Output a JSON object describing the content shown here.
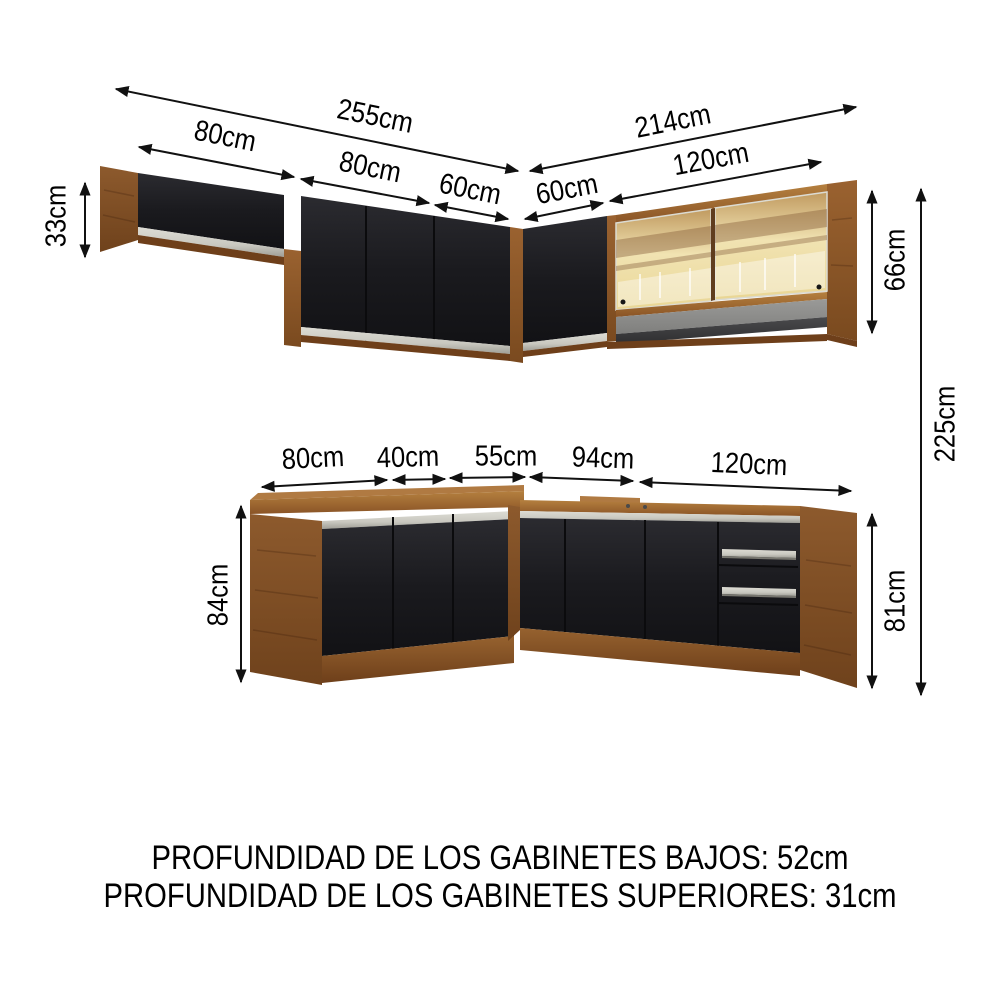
{
  "page": {
    "background": "#ffffff"
  },
  "colors": {
    "background": "#ffffff",
    "wood": "#8d5a2b",
    "wood_light": "#b07a42",
    "wood_dark": "#6e3f1a",
    "door_black": "#1a1a1e",
    "handle_silver": "#c9c8c0",
    "glass_amber": "#eedfab",
    "glass_reflection_brown": "#8a5e3c",
    "shelf_gray": "#8f8f8d",
    "shelf_shadow": "#3c3c3e",
    "dimension_line": "#111111",
    "text": "#000000"
  },
  "measurements": {
    "upper": {
      "left_total": "255cm",
      "right_total": "214cm",
      "left_segments": [
        "80cm",
        "80cm",
        "60cm"
      ],
      "right_segments": [
        "60cm",
        "120cm"
      ],
      "left_height": "33cm",
      "right_height": "66cm"
    },
    "lower": {
      "segments": [
        "80cm",
        "40cm",
        "55cm",
        "94cm",
        "120cm"
      ],
      "left_height": "84cm",
      "right_height": "81cm"
    },
    "total_height": "225cm"
  },
  "footer": {
    "line1": "PROFUNDIDAD DE LOS GABINETES BAJOS: 52cm",
    "line2": "PROFUNDIDAD DE LOS GABINETES SUPERIORES: 31cm"
  }
}
